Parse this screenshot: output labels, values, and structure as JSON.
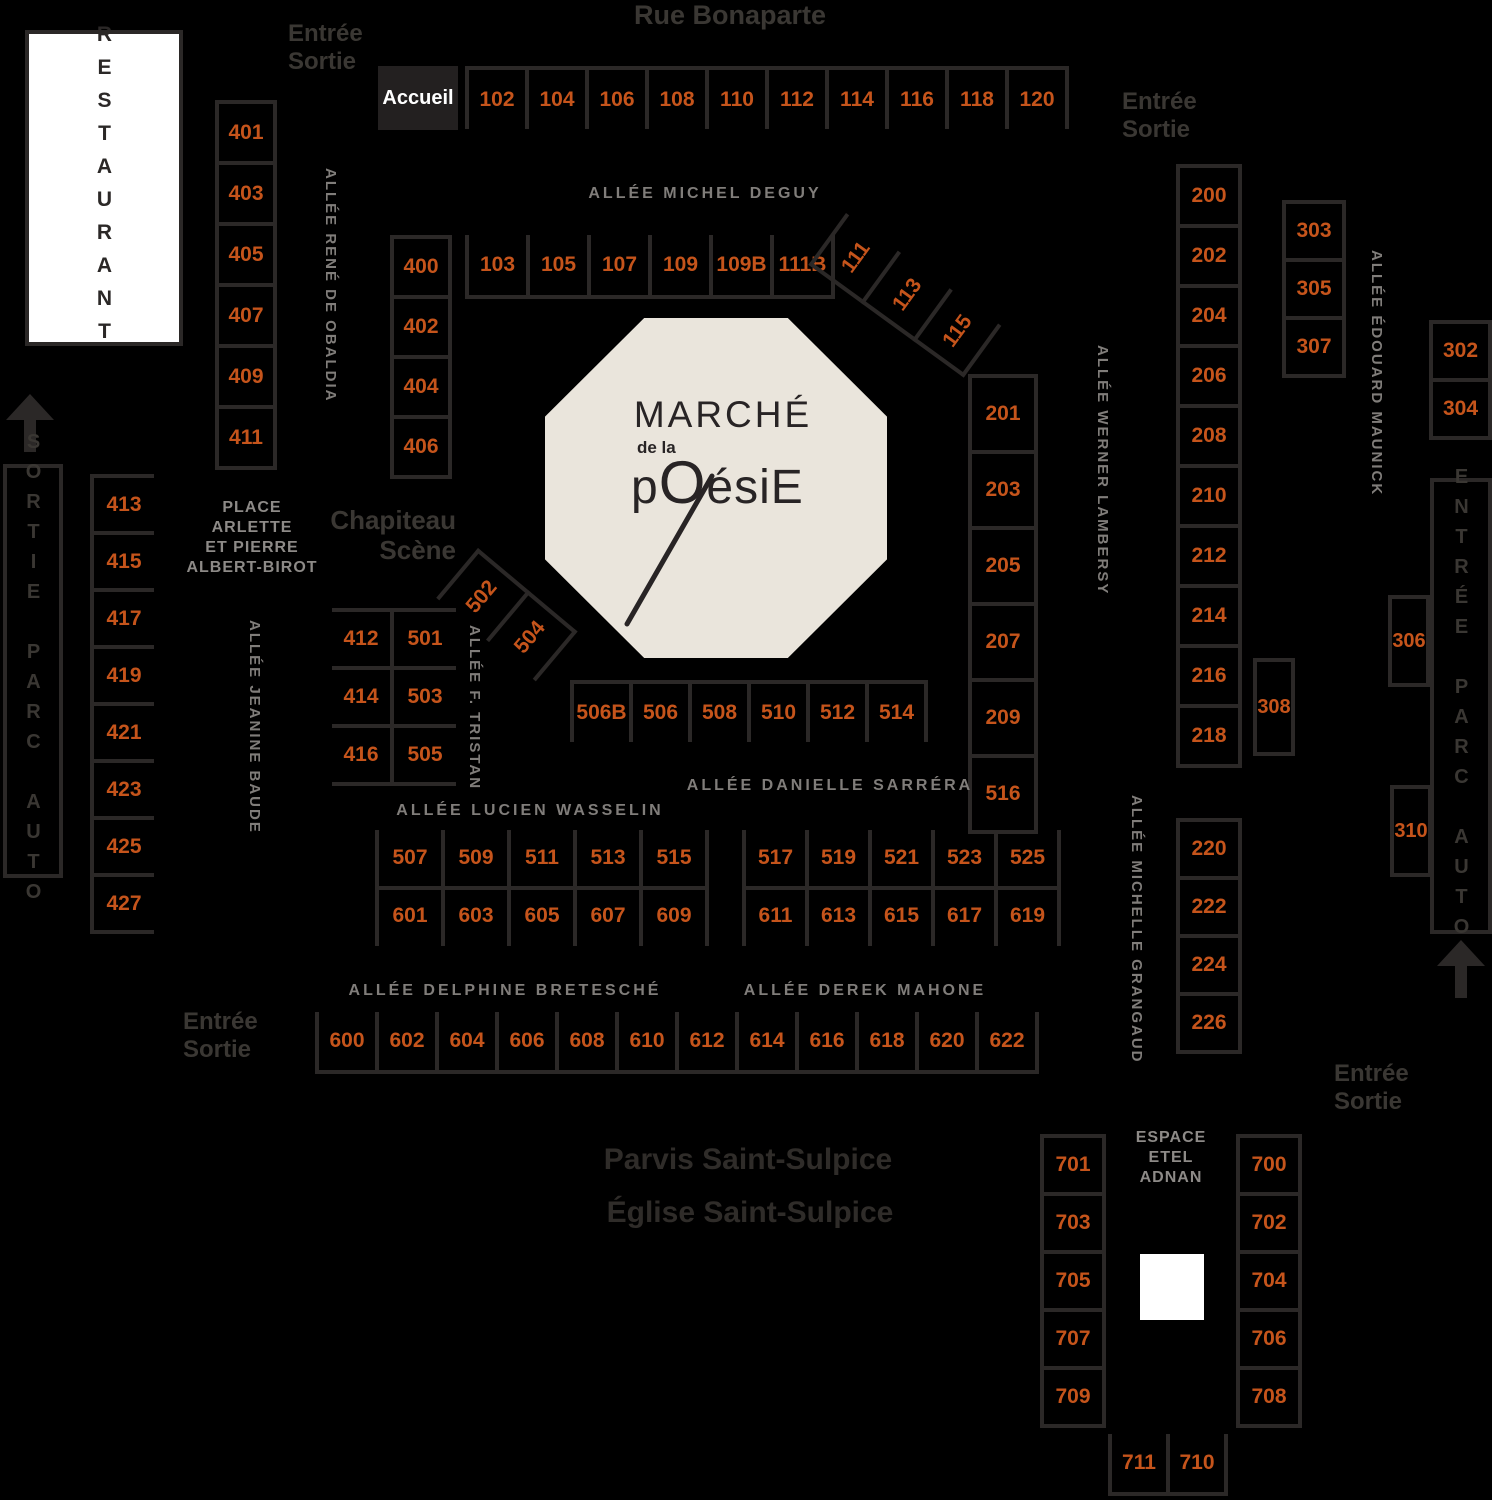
{
  "colors": {
    "orange": "#c5541b",
    "line": "#2b2827",
    "octagon_fill": "#eae5dc",
    "background": "#000000"
  },
  "streets": {
    "rue_bonaparte": "Rue Bonaparte",
    "parvis": "Parvis Saint-Sulpice",
    "eglise": "Église Saint-Sulpice"
  },
  "labels": {
    "entree": "Entrée",
    "sortie": "Sortie",
    "accueil": "Accueil",
    "restaurant": "RESTAURANT",
    "sortie_parc_auto": "SORTIE PARC AUTO",
    "entree_parc_auto": "ENTRÉE PARC AUTO",
    "chapiteau_1": "Chapiteau",
    "chapiteau_2": "Scène",
    "place_1": "PLACE",
    "place_2": "ARLETTE",
    "place_3": "ET PIERRE",
    "place_4": "ALBERT-BIROT",
    "espace_1": "ESPACE",
    "espace_2": "ETEL",
    "espace_3": "ADNAN"
  },
  "alleys": {
    "michel_deguy": "ALLÉE MICHEL DEGUY",
    "rene_obaldia": "ALLÉE RENÉ DE OBALDIA",
    "werner_lambersy": "ALLÉE WERNER LAMBERSY",
    "edouard_maunick": "ALLÉE ÉDOUARD MAUNICK",
    "michelle_grangaud": "ALLÉE MICHELLE GRANGAUD",
    "jeanine_baude": "ALLÉE JEANINE BAUDE",
    "f_tristan": "ALLÉE F. TRISTAN",
    "danielle_sarrera": "ALLÉE DANIELLE SARRÉRA",
    "lucien_wasselin": "ALLÉE LUCIEN WASSELIN",
    "delphine_bretesche": "ALLÉE DELPHINE BRETESCHÉ",
    "derek_mahone": "ALLÉE DEREK MAHONE"
  },
  "logo": {
    "line1": "MARCHÉ",
    "line2": "de la",
    "line3p": "p",
    "line3O": "O",
    "line3rest": "ésiE"
  },
  "stands": {
    "row_bonaparte": [
      "102",
      "104",
      "106",
      "108",
      "110",
      "112",
      "114",
      "116",
      "118",
      "120"
    ],
    "row_deguy": [
      "103",
      "105",
      "107",
      "109",
      "109B",
      "111B"
    ],
    "diag_ne": [
      "111",
      "113",
      "115"
    ],
    "col_401": [
      "401",
      "403",
      "405",
      "407",
      "409",
      "411"
    ],
    "col_400": [
      "400",
      "402",
      "404",
      "406"
    ],
    "col_413": [
      "413",
      "415",
      "417",
      "419",
      "421",
      "423",
      "425",
      "427"
    ],
    "chap_left": [
      "412",
      "414",
      "416"
    ],
    "chap_right": [
      "501",
      "503",
      "505"
    ],
    "diag_sw": [
      "502",
      "504"
    ],
    "row_506": [
      "506B",
      "506",
      "508",
      "510",
      "512",
      "514"
    ],
    "col_201": [
      "201",
      "203",
      "205",
      "207",
      "209",
      "516"
    ],
    "col_200": [
      "200",
      "202",
      "204",
      "206",
      "208",
      "210",
      "212",
      "214",
      "216",
      "218"
    ],
    "col_220": [
      "220",
      "222",
      "224",
      "226"
    ],
    "col_303": [
      "303",
      "305",
      "307"
    ],
    "col_302": [
      "302",
      "304"
    ],
    "box_306": "306",
    "box_308": "308",
    "box_310": "310",
    "wasselin_top": [
      "507",
      "509",
      "511",
      "513",
      "515"
    ],
    "wasselin_bottom": [
      "601",
      "603",
      "605",
      "607",
      "609"
    ],
    "sarrera_top": [
      "517",
      "519",
      "521",
      "523",
      "525"
    ],
    "sarrera_bottom": [
      "611",
      "613",
      "615",
      "617",
      "619"
    ],
    "row_600": [
      "600",
      "602",
      "604",
      "606",
      "608",
      "610",
      "612",
      "614",
      "616",
      "618",
      "620",
      "622"
    ],
    "espace_left": [
      "701",
      "703",
      "705",
      "707",
      "709"
    ],
    "espace_right": [
      "700",
      "702",
      "704",
      "706",
      "708"
    ],
    "espace_bottom": [
      "711",
      "710"
    ]
  }
}
